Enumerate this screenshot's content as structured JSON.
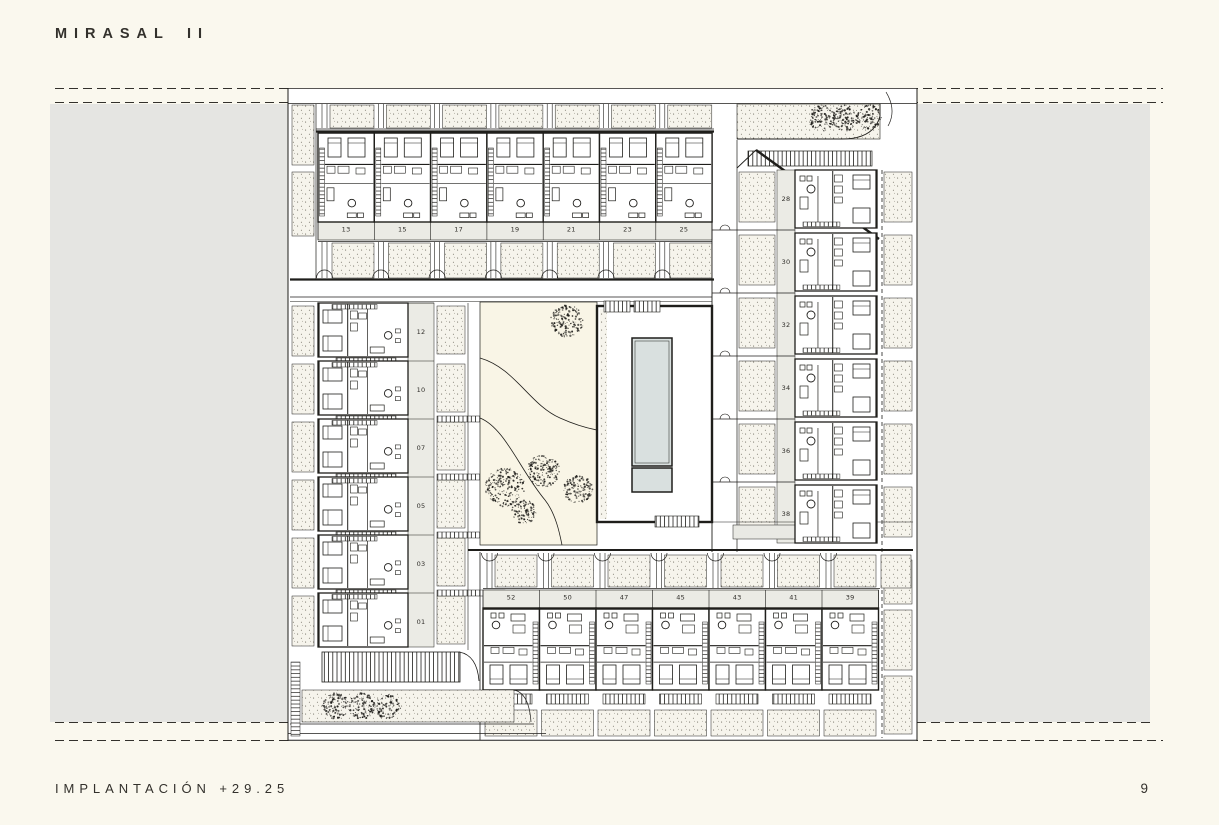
{
  "page": {
    "title": "MIRASAL II",
    "footer_left": "IMPLANTACIÓN +29.25",
    "page_number": "9"
  },
  "colors": {
    "background": "#FAF8EE",
    "band_gray": "#E5E5E2",
    "line": "#1F1E1B",
    "plan_bg": "#FFFFFF",
    "garden_cream": "#F9F5E6",
    "stipple_bg": "#F6F4EC",
    "pool_fill": "#D9E0DF",
    "label_strip": "#EBEBE5",
    "text": "#2E2C28"
  },
  "plan": {
    "top_row_units": [
      "13",
      "15",
      "17",
      "19",
      "21",
      "23",
      "25"
    ],
    "left_column_units": [
      "12",
      "10",
      "07",
      "05",
      "03",
      "01"
    ],
    "right_column_units": [
      "28",
      "30",
      "32",
      "34",
      "36",
      "38"
    ],
    "bottom_row_units": [
      "52",
      "50",
      "47",
      "45",
      "43",
      "41",
      "39"
    ]
  }
}
